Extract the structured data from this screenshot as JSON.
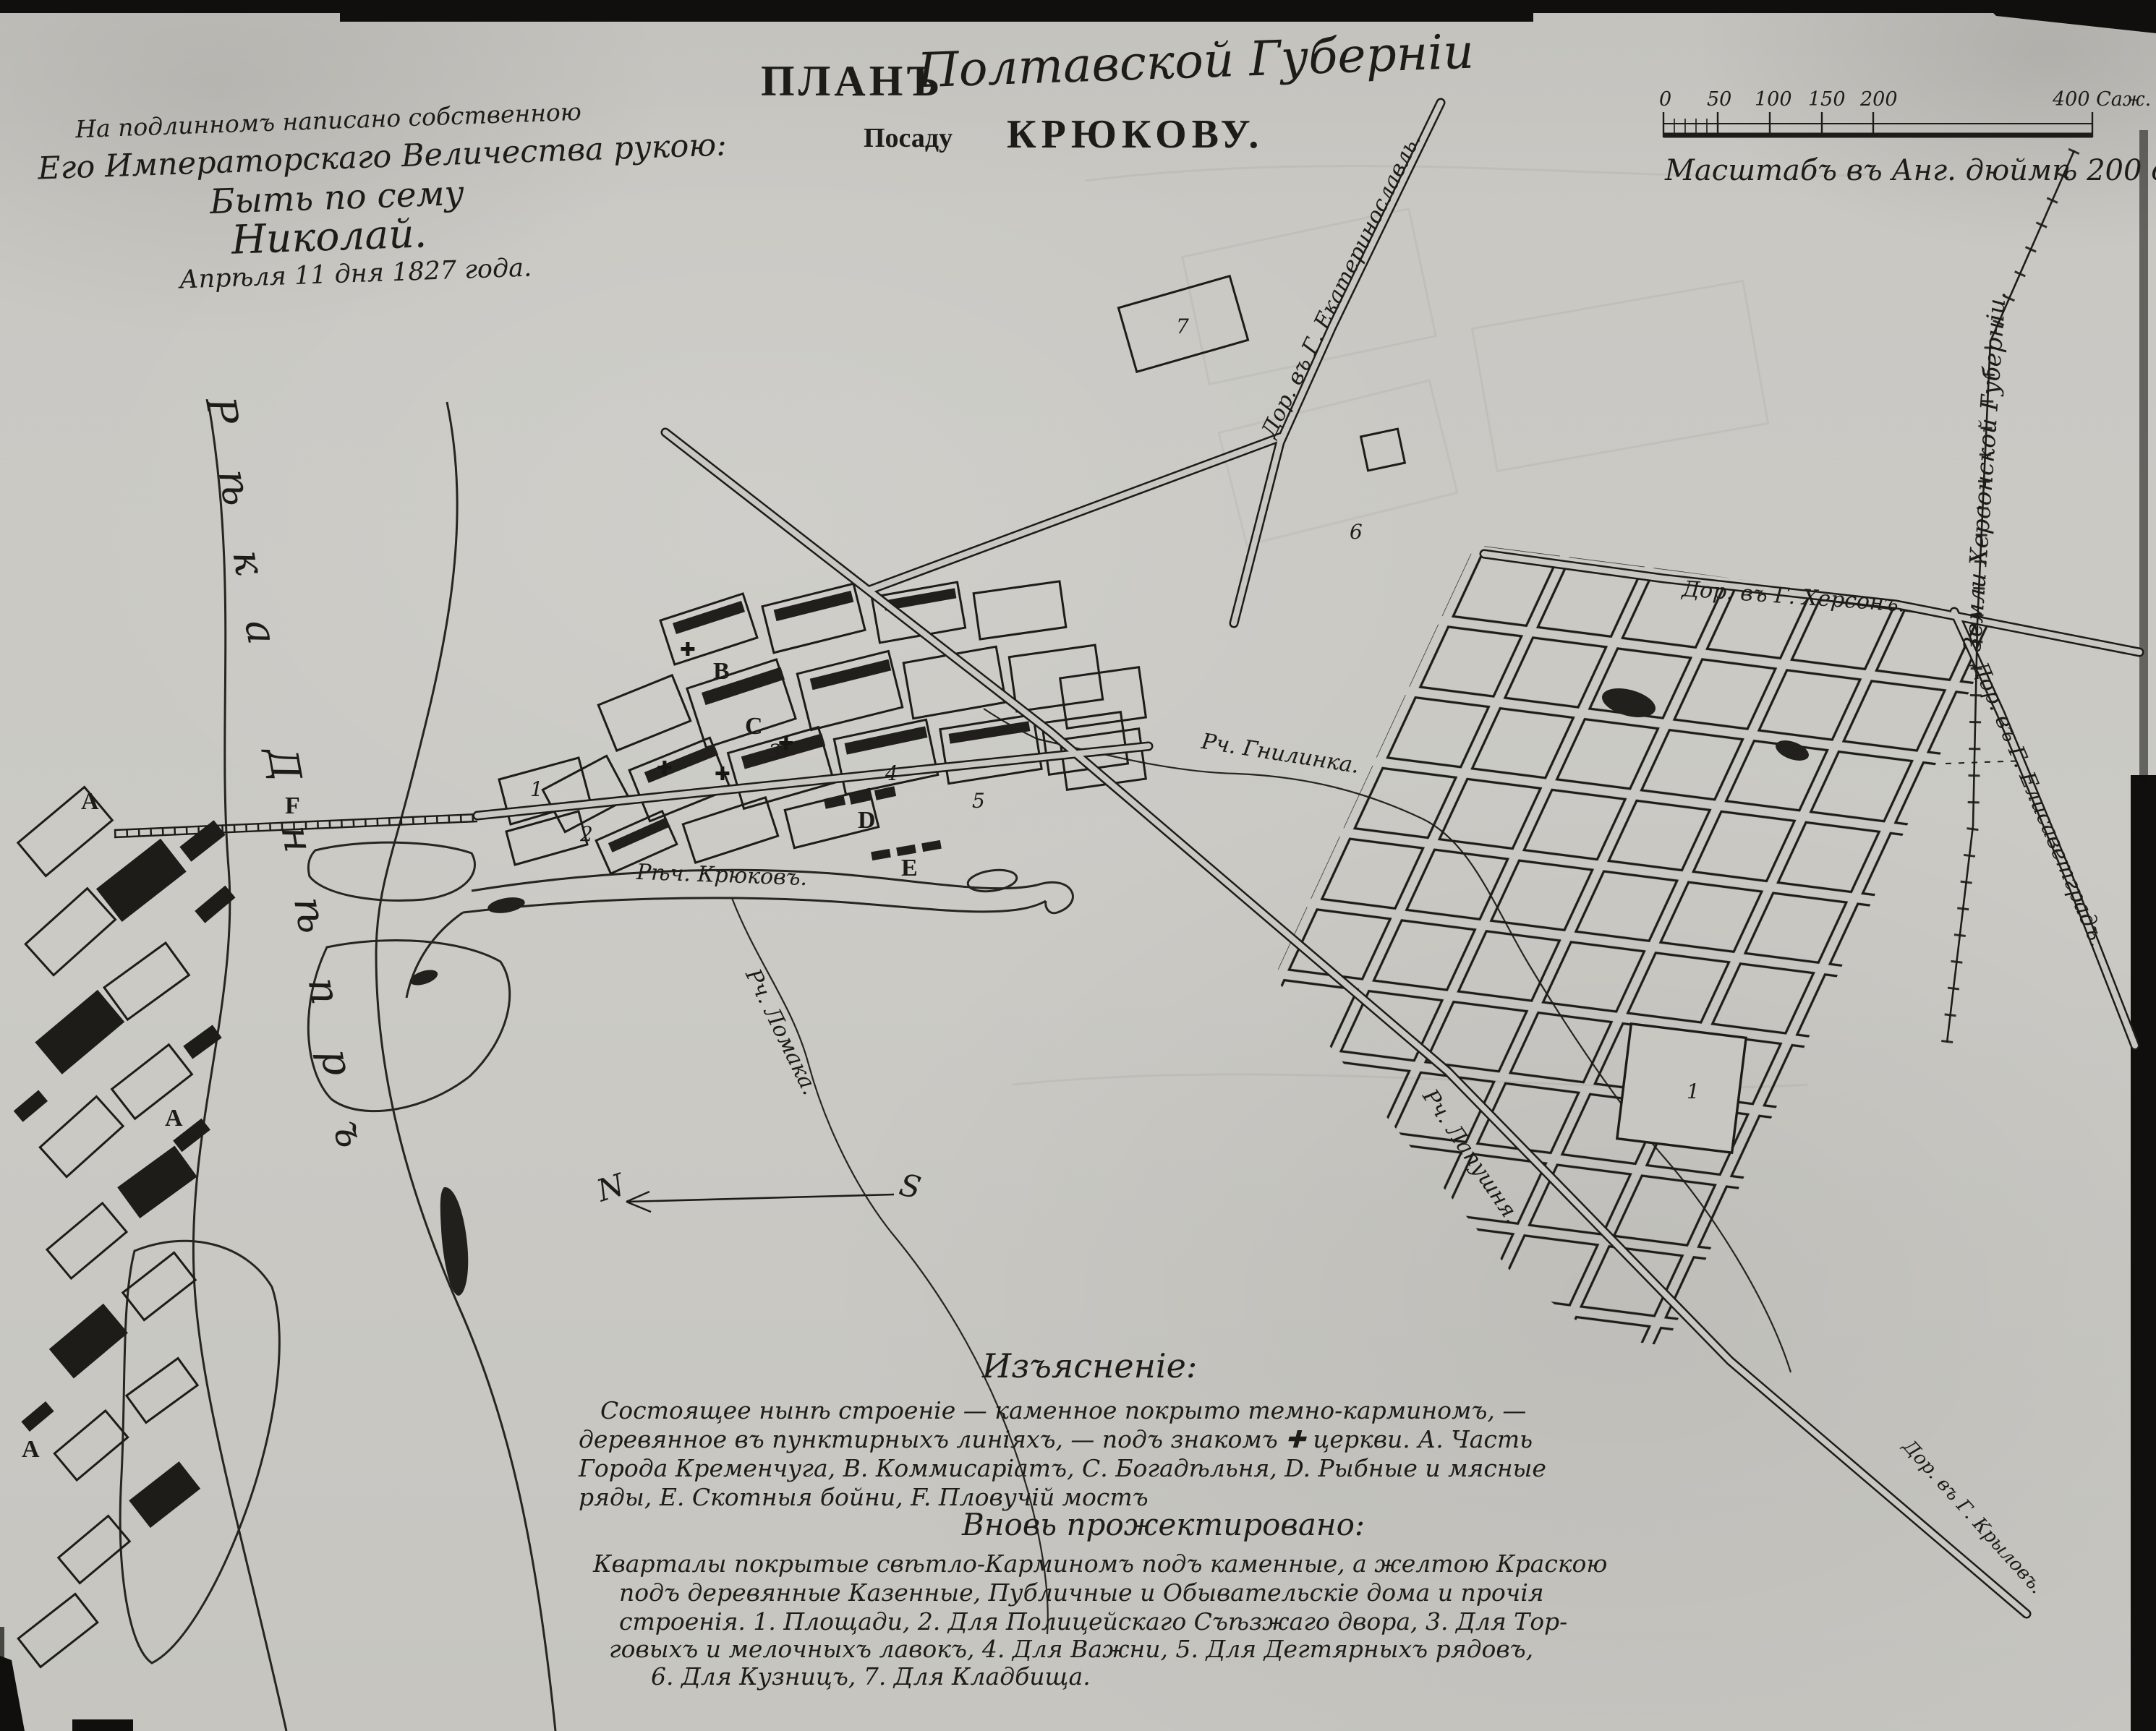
{
  "colors": {
    "paper": "#c8c7c2",
    "ink": "#1d1c19"
  },
  "title": {
    "plan": "ПЛАНЪ",
    "region": "Полтавской Губерніи",
    "line2_prefix": "Посаду",
    "line2_name": "КРЮКОВУ."
  },
  "imperial_note": {
    "line1": "На подлинномъ написано собственною",
    "line2": "Его Императорскаго Величества рукою:",
    "line3": "Быть по сему",
    "line4": "Николай.",
    "line5": "Апрѣля 11 дня 1827 года."
  },
  "scale_bar": {
    "ticks": [
      "0",
      "50",
      "100",
      "150",
      "200"
    ],
    "end_label": "400 Саж.",
    "caption": "Масштабъ въ Анг. дюймѣ 200 саженъ."
  },
  "legend": {
    "header": "Изъясненіе:",
    "body1": [
      "Состоящее нынѣ строеніе — каменное покрыто темно-карминомъ, —",
      "деревянное въ пунктирныхъ линіяхъ, — подъ знакомъ ✚ церкви.        А. Часть",
      "Города Кременчуга, В. Коммисаріатъ, С. Богадѣльня, D. Рыбные и мясные",
      "ряды, Е. Скотныя бойни, F. Пловучій мостъ"
    ],
    "subheader": "Вновь прожектировано:",
    "body2": [
      "Кварталы покрытые свѣтло-Карминомъ подъ каменные, а желтою Краскою",
      "подъ деревянные Казенные, Публичные и Обывательскіе дома и прочія",
      "строенія. 1. Площади, 2. Для Полицейскаго Съѣзжаго двора, 3. Для Тор-",
      "говыхъ и мелочныхъ лавокъ, 4. Для Важни, 5. Для Дегтярныхъ рядовъ,",
      "6. Для Кузницъ, 7. Для Кладбища."
    ]
  },
  "roads": {
    "ekaterinoslav": "Дор. въ Г. Екатеринославль.",
    "kherson": "Дор. въ Г. Херсонъ.",
    "elisavetgrad": "Дор. въ Г. Елисаветградъ.",
    "krylov": "Дор. въ Г. Крыловъ.",
    "boundary": "Земли Херсонской Губерніи."
  },
  "waters": {
    "dnieper": "Рѣка Днѣпръ",
    "kryukov": "Рѣч. Крюковъ.",
    "gnilinka": "Рч. Гнилинка.",
    "lomaka": "Рч. Ломака.",
    "lapushnya": "Рч. Лапушня."
  },
  "map_letters": {
    "a": "A",
    "b": "B",
    "c": "C",
    "d": "D",
    "e": "E",
    "f": "F"
  },
  "map_numbers": [
    "1",
    "2",
    "3",
    "4",
    "5",
    "6",
    "7"
  ],
  "symbols": {
    "church": "✚",
    "north": "N",
    "south": "S"
  }
}
